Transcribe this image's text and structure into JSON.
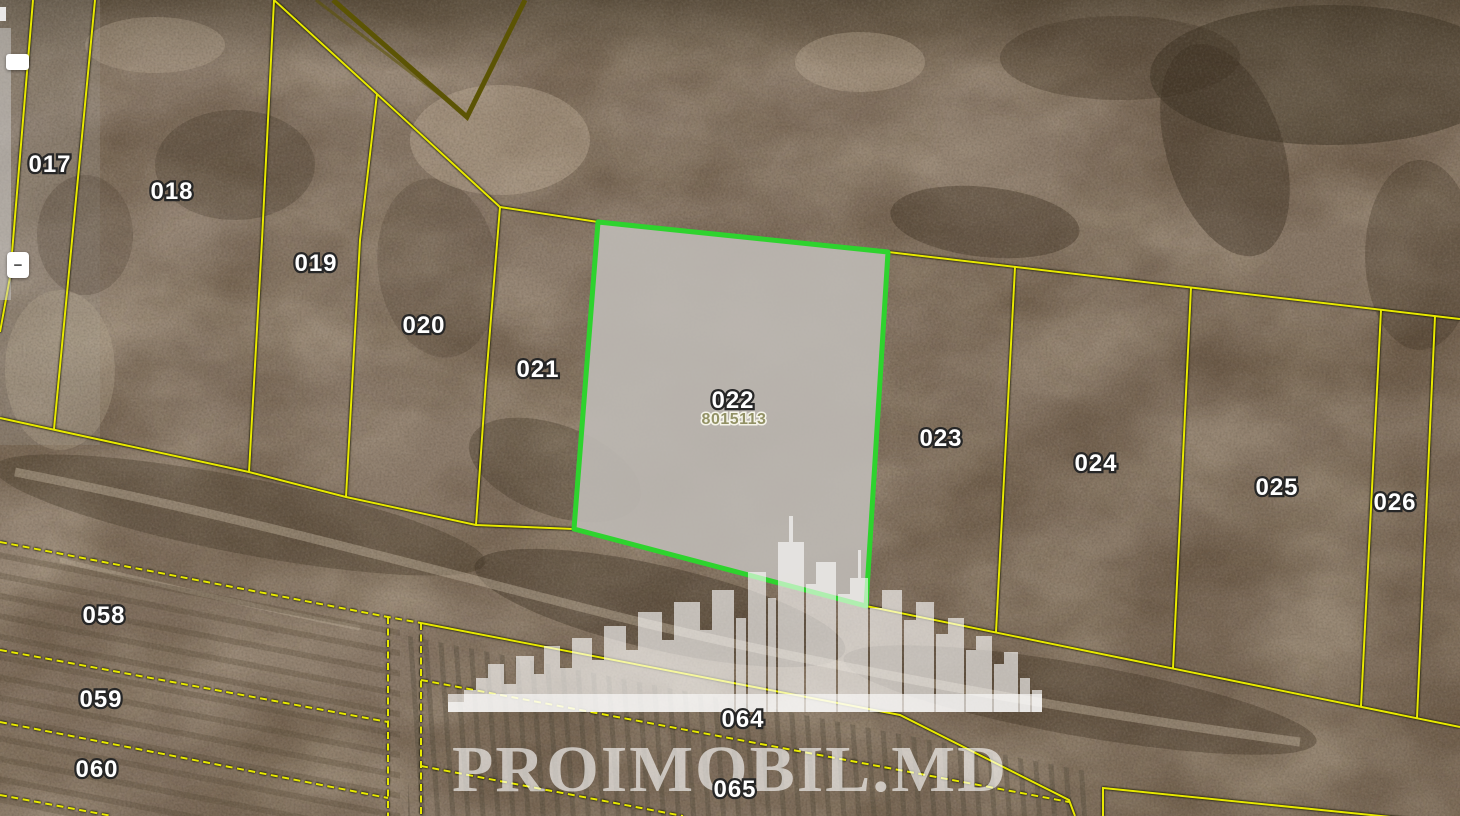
{
  "watermark": {
    "brand": "PROIMOBIL.MD",
    "icon": "city-skyline",
    "color": "#ffffff"
  },
  "controls": {
    "zoom_in_label": "",
    "zoom_out_label": "−"
  },
  "selected_parcel": {
    "id": "022",
    "cadastral_number": "8015113"
  },
  "parcel_labels": [
    {
      "id": "017",
      "x": 50,
      "y": 172
    },
    {
      "id": "018",
      "x": 172,
      "y": 199
    },
    {
      "id": "019",
      "x": 316,
      "y": 271
    },
    {
      "id": "020",
      "x": 424,
      "y": 333
    },
    {
      "id": "021",
      "x": 538,
      "y": 377
    },
    {
      "id": "022",
      "x": 733,
      "y": 408
    },
    {
      "id": "8015113",
      "x": 734,
      "y": 424,
      "variant": "sub"
    },
    {
      "id": "023",
      "x": 941,
      "y": 446
    },
    {
      "id": "024",
      "x": 1096,
      "y": 471
    },
    {
      "id": "025",
      "x": 1277,
      "y": 495
    },
    {
      "id": "026",
      "x": 1395,
      "y": 510
    },
    {
      "id": "058",
      "x": 104,
      "y": 623
    },
    {
      "id": "059",
      "x": 101,
      "y": 707
    },
    {
      "id": "060",
      "x": 97,
      "y": 777
    },
    {
      "id": "064",
      "x": 743,
      "y": 727
    },
    {
      "id": "065",
      "x": 735,
      "y": 797
    }
  ],
  "colors": {
    "parcel_line": "#e8e900",
    "commune_line": "#5c5404",
    "selected_stroke": "#2ed32e",
    "selected_fill": "#bdb9b3",
    "label_fill": "#ffffff",
    "label_outline": "#262626",
    "sub_label_fill": "#8e8e5e",
    "watermark_white": "#ffffff"
  }
}
